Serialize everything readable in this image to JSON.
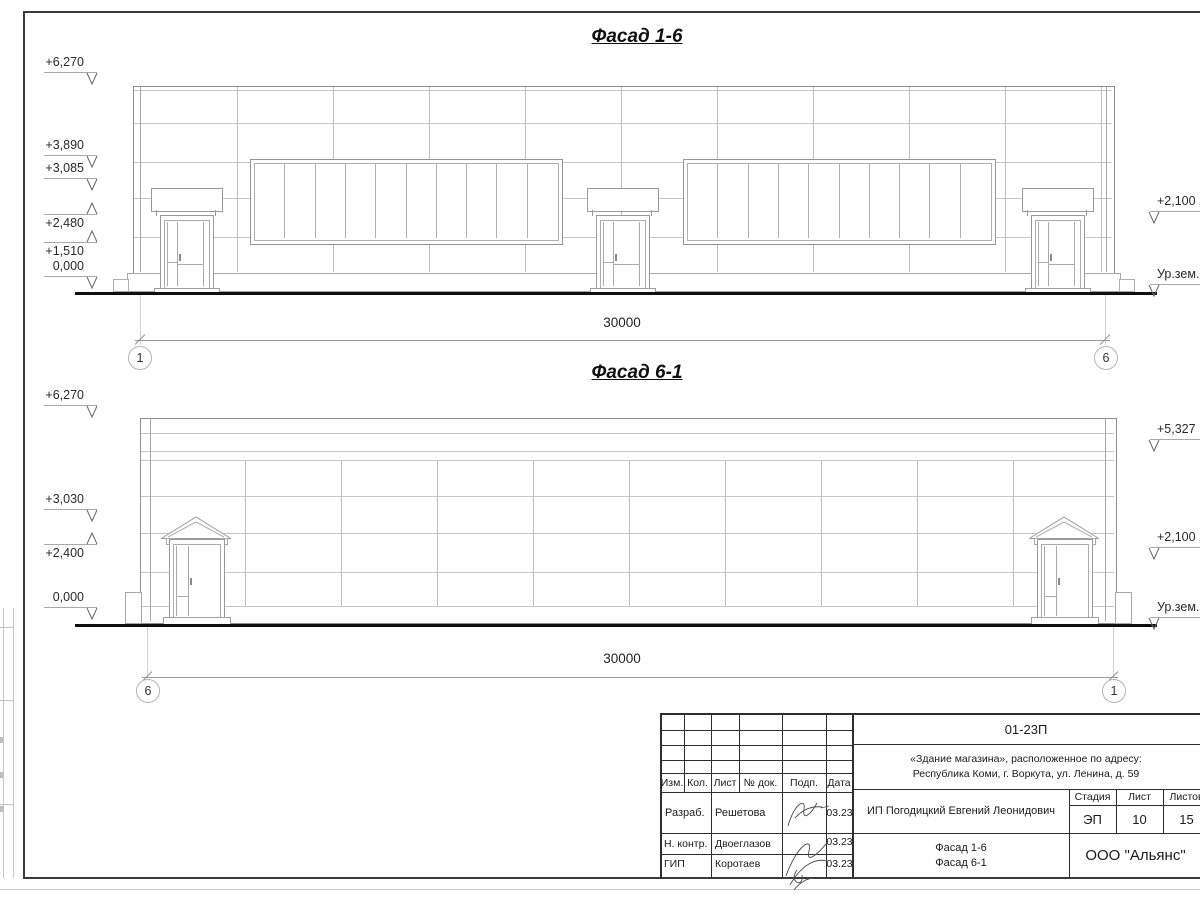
{
  "facade1": {
    "title": "Фасад 1-6",
    "elevation_marks_left": [
      "+6,270",
      "+3,890",
      "+3,085",
      "+2,480",
      "+1,510",
      "0,000"
    ],
    "elevation_marks_right": [
      "+2,100",
      "Ур.зем."
    ],
    "dimension": "30000",
    "axis_bubble_left": "1",
    "axis_bubble_right": "6"
  },
  "facade2": {
    "title": "Фасад 6-1",
    "elevation_marks_left": [
      "+6,270",
      "+3,030",
      "+2,400",
      "0,000"
    ],
    "elevation_marks_right": [
      "+5,327",
      "+2,100",
      "Ур.зем."
    ],
    "dimension": "30000",
    "axis_bubble_left": "6",
    "axis_bubble_right": "1"
  },
  "title_block": {
    "doc_code": "01-23П",
    "address_line1": "«Здание магазина», расположенное по адресу:",
    "address_line2": "Республика Коми, г. Воркута, ул. Ленина, д. 59",
    "col_headers": [
      "Изм.",
      "Кол.",
      "Лист",
      "№ док.",
      "Подп.",
      "Дата"
    ],
    "rows": [
      {
        "role": "Разраб.",
        "name": "Решетова",
        "date": "03.23"
      },
      {
        "role": "Н. контр.",
        "name": "Двоеглазов",
        "date": "03.23"
      },
      {
        "role": "ГИП",
        "name": "Коротаев",
        "date": "03.23"
      }
    ],
    "client": "ИП Погодицкий Евгений Леонидович",
    "stage_headers": [
      "Стадия",
      "Лист",
      "Листов"
    ],
    "stage_values": [
      "ЭП",
      "10",
      "15"
    ],
    "sheet_title_line1": "Фасад 1-6",
    "sheet_title_line2": "Фасад 6-1",
    "org": "ООО \"Альянс\""
  }
}
